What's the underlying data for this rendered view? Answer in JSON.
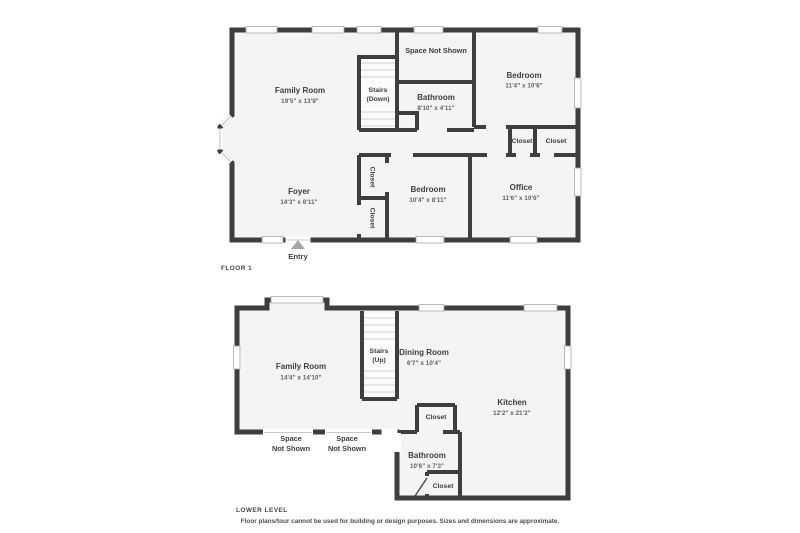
{
  "page": {
    "background": "#ffffff",
    "colors": {
      "wall": "#3e3e3e",
      "room_fill": "#f4f4f4",
      "window_border": "#a9a9a9",
      "label_text": "#3d3d3d",
      "dims_text": "#5e5e5e",
      "entry_arrow": "#a6a6a6",
      "stair_tread": "#d2d2d2"
    }
  },
  "floor1": {
    "title": "FLOOR 1",
    "entry": "Entry",
    "rooms": {
      "family_room": {
        "name": "Family Room",
        "dims": "19'5\" x 13'9\""
      },
      "stairs": {
        "name": "Stairs",
        "direction": "(Down)"
      },
      "space_not_shown": {
        "name": "Space Not Shown"
      },
      "bathroom": {
        "name": "Bathroom",
        "dims": "8'10\" x 4'11\""
      },
      "bedroom_top": {
        "name": "Bedroom",
        "dims": "11'4\" x 10'6\""
      },
      "closet_1": {
        "name": "Closet"
      },
      "closet_2": {
        "name": "Closet"
      },
      "foyer": {
        "name": "Foyer",
        "dims": "14'3\" x 8'11\""
      },
      "closet_3": {
        "name": "Closet"
      },
      "closet_4": {
        "name": "Closet"
      },
      "bedroom_bottom": {
        "name": "Bedroom",
        "dims": "10'4\" x 8'11\""
      },
      "office": {
        "name": "Office",
        "dims": "11'6\" x 10'6\""
      }
    }
  },
  "lower_level": {
    "title": "LOWER LEVEL",
    "rooms": {
      "family_room": {
        "name": "Family Room",
        "dims": "14'4\" x 14'10\""
      },
      "stairs": {
        "name": "Stairs",
        "direction": "(Up)"
      },
      "dining_room": {
        "name": "Dining Room",
        "dims": "6'7\" x 10'4\""
      },
      "kitchen": {
        "name": "Kitchen",
        "dims": "12'2\" x 21'2\""
      },
      "closet_1": {
        "name": "Closet"
      },
      "space_not_shown_1": {
        "line1": "Space",
        "line2": "Not Shown"
      },
      "space_not_shown_2": {
        "line1": "Space",
        "line2": "Not Shown"
      },
      "bathroom": {
        "name": "Bathroom",
        "dims": "10'6\" x 7'3\""
      },
      "closet_2": {
        "name": "Closet"
      }
    }
  },
  "footer": {
    "disclaimer": "Floor plans/tour cannot be used for building or design purposes. Sizes and dimensions are approximate."
  }
}
